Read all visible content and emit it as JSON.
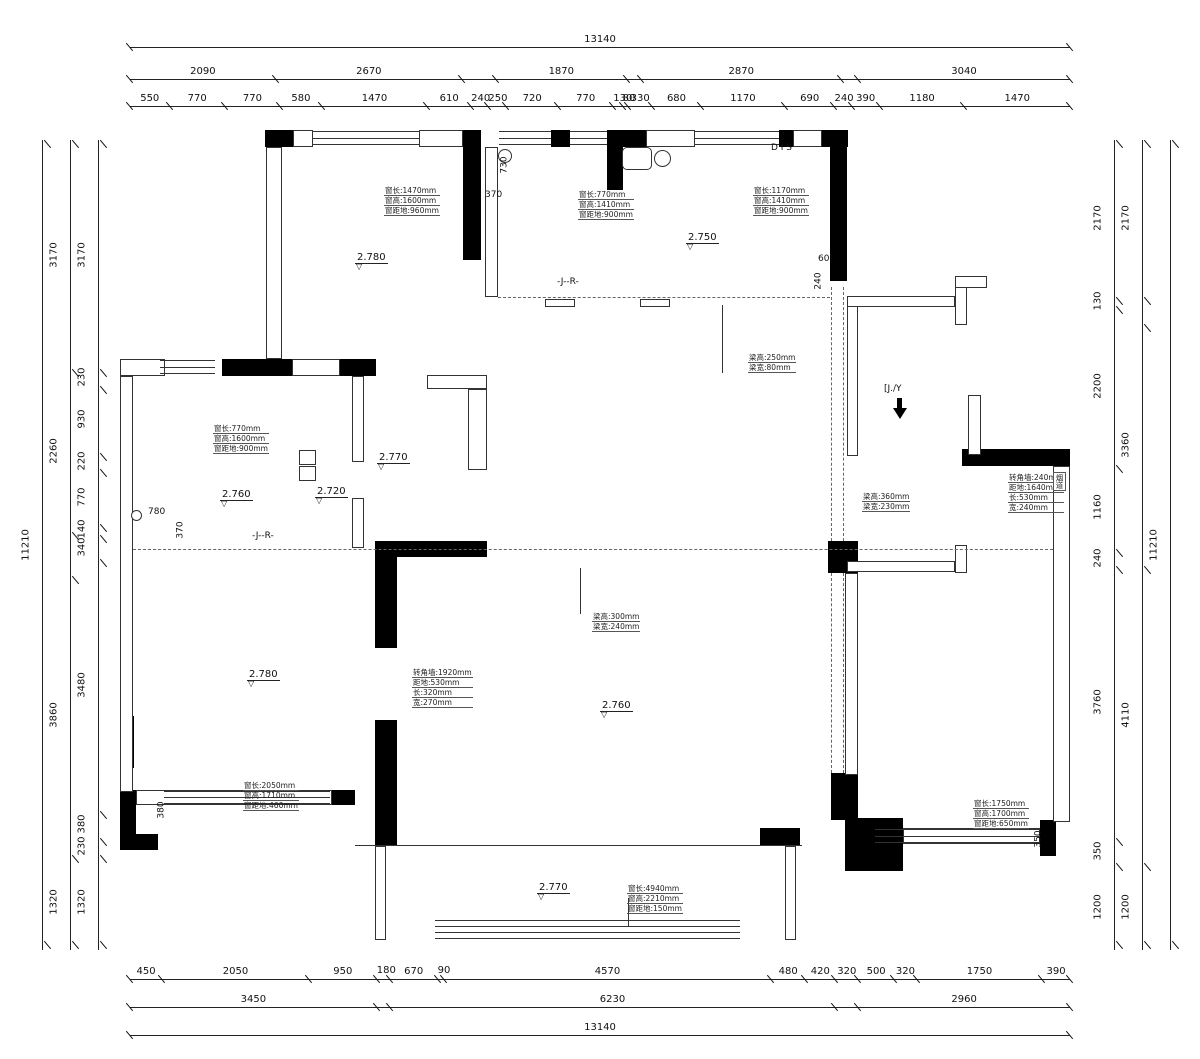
{
  "drawing": {
    "type": "floor-plan-measurement-drawing",
    "line_color": "#222222",
    "wall_fill": "#000000"
  },
  "dims": {
    "top1": [
      {
        "v": 13140
      }
    ],
    "top2": [
      {
        "v": 2090
      },
      {
        "v": 2670
      },
      {
        "v": 490,
        "hide": true
      },
      {
        "v": 1870
      },
      {
        "v": 210,
        "hide": true
      },
      {
        "v": 2870
      },
      {
        "v": 240,
        "hide": true
      },
      {
        "v": 3040
      }
    ],
    "top3": [
      {
        "v": 550
      },
      {
        "v": 770
      },
      {
        "v": 770
      },
      {
        "v": 580
      },
      {
        "v": 1470
      },
      {
        "v": 610
      },
      {
        "v": 240
      },
      {
        "v": 250
      },
      {
        "v": 720
      },
      {
        "v": 770
      },
      {
        "v": 130
      },
      {
        "v": 80
      },
      {
        "v": 330
      },
      {
        "v": 680
      },
      {
        "v": 1170
      },
      {
        "v": 690
      },
      {
        "v": 240
      },
      {
        "v": 390
      },
      {
        "v": 1180
      },
      {
        "v": 1470
      }
    ],
    "bottom1": [
      {
        "v": 450
      },
      {
        "v": 2050
      },
      {
        "v": 950
      },
      {
        "v": 180,
        "below": true
      },
      {
        "v": 670
      },
      {
        "v": 90,
        "below": true
      },
      {
        "v": 4570
      },
      {
        "v": 480
      },
      {
        "v": 420
      },
      {
        "v": 320
      },
      {
        "v": 500
      },
      {
        "v": 320
      },
      {
        "v": 1750
      },
      {
        "v": 390
      }
    ],
    "bottom2": [
      {
        "v": 3450
      },
      {
        "v": 180,
        "hide": true
      },
      {
        "v": 6230
      },
      {
        "v": 320,
        "hide": true
      },
      {
        "v": 2960
      }
    ],
    "bottom3": [
      {
        "v": 13140
      }
    ],
    "left_outer": [
      {
        "v": 11210
      }
    ],
    "left_mid": [
      {
        "v": 3170
      },
      {
        "v": 2260
      },
      {
        "v": 600,
        "hide": true
      },
      {
        "v": 3860
      },
      {
        "v": 1320
      }
    ],
    "left_inner": [
      {
        "v": 3170
      },
      {
        "v": 230
      },
      {
        "v": 930
      },
      {
        "v": 220
      },
      {
        "v": 770
      },
      {
        "v": 140
      },
      {
        "v": 340
      },
      {
        "v": 3480
      },
      {
        "v": 380
      },
      {
        "v": 230
      },
      {
        "v": 1320
      }
    ],
    "right_inner": [
      {
        "v": 2170
      },
      {
        "v": 130
      },
      {
        "v": 2200
      },
      {
        "v": 1160
      },
      {
        "v": 240
      },
      {
        "v": 3760
      },
      {
        "v": 350
      },
      {
        "v": 1200
      }
    ],
    "right_mid": [
      {
        "v": 2170
      },
      {
        "v": 370,
        "hide": true
      },
      {
        "v": 3360
      },
      {
        "v": 4110
      },
      {
        "v": 1200
      }
    ],
    "right_outer": [
      {
        "v": 11210
      }
    ]
  },
  "annotations": [
    {
      "x": 384,
      "y": 186,
      "lines": [
        "窗长:1470mm",
        "窗高:1600mm",
        "窗距地:960mm"
      ]
    },
    {
      "x": 578,
      "y": 190,
      "lines": [
        "窗长:770mm",
        "窗高:1410mm",
        "窗距地:900mm"
      ]
    },
    {
      "x": 753,
      "y": 186,
      "lines": [
        "窗长:1170mm",
        "窗高:1410mm",
        "窗距地:900mm"
      ]
    },
    {
      "x": 213,
      "y": 424,
      "lines": [
        "窗长:770mm",
        "窗高:1600mm",
        "窗距地:900mm"
      ]
    },
    {
      "x": 748,
      "y": 353,
      "lines": [
        "梁高:250mm",
        "梁宽:80mm"
      ]
    },
    {
      "x": 862,
      "y": 492,
      "lines": [
        "梁高:360mm",
        "梁宽:230mm"
      ]
    },
    {
      "x": 1008,
      "y": 473,
      "lines": [
        "转角墙:240mm",
        "距地:1640mm",
        "长:530mm",
        "宽:240mm"
      ]
    },
    {
      "x": 592,
      "y": 612,
      "lines": [
        "梁高:300mm",
        "梁宽:240mm"
      ]
    },
    {
      "x": 412,
      "y": 668,
      "lines": [
        "转角墙:1920mm",
        "距地:530mm",
        "长:320mm",
        "宽:270mm"
      ]
    },
    {
      "x": 243,
      "y": 781,
      "lines": [
        "窗长:2050mm",
        "窗高:1710mm",
        "窗距地:460mm"
      ]
    },
    {
      "x": 973,
      "y": 799,
      "lines": [
        "窗长:1750mm",
        "窗高:1700mm",
        "窗距地:650mm"
      ]
    },
    {
      "x": 627,
      "y": 884,
      "lines": [
        "窗长:4940mm",
        "窗高:2210mm",
        "窗距地:150mm"
      ]
    }
  ],
  "levels": [
    {
      "x": 355,
      "y": 252,
      "v": "2.780"
    },
    {
      "x": 686,
      "y": 232,
      "v": "2.750"
    },
    {
      "x": 377,
      "y": 452,
      "v": "2.770"
    },
    {
      "x": 220,
      "y": 489,
      "v": "2.760"
    },
    {
      "x": 315,
      "y": 486,
      "v": "2.720"
    },
    {
      "x": 247,
      "y": 669,
      "v": "2.780"
    },
    {
      "x": 600,
      "y": 700,
      "v": "2.760"
    },
    {
      "x": 537,
      "y": 882,
      "v": "2.770"
    }
  ],
  "labels": [
    {
      "x": 771,
      "y": 143,
      "t": "D I S",
      "cls": "small"
    },
    {
      "x": 557,
      "y": 277,
      "t": "-J--R-",
      "cls": "small"
    },
    {
      "x": 252,
      "y": 531,
      "t": "-J--R-",
      "cls": "small"
    },
    {
      "x": 884,
      "y": 384,
      "t": "[J./Y",
      "cls": "small"
    },
    {
      "x": 485,
      "y": 190,
      "t": "370",
      "cls": "small"
    },
    {
      "x": 496,
      "y": 160,
      "t": "730",
      "cls": "small rot"
    },
    {
      "x": 818,
      "y": 254,
      "t": "60",
      "cls": "small"
    },
    {
      "x": 810,
      "y": 276,
      "t": "240",
      "cls": "small rot"
    },
    {
      "x": 148,
      "y": 507,
      "t": "780",
      "cls": "small"
    },
    {
      "x": 172,
      "y": 525,
      "t": "370",
      "cls": "small rot"
    },
    {
      "x": 153,
      "y": 805,
      "t": "380",
      "cls": "small rot"
    },
    {
      "x": 1030,
      "y": 834,
      "t": "350",
      "cls": "small rot"
    }
  ],
  "vlabels": [
    {
      "x": 1053,
      "y": 472,
      "t": "烟道"
    }
  ]
}
